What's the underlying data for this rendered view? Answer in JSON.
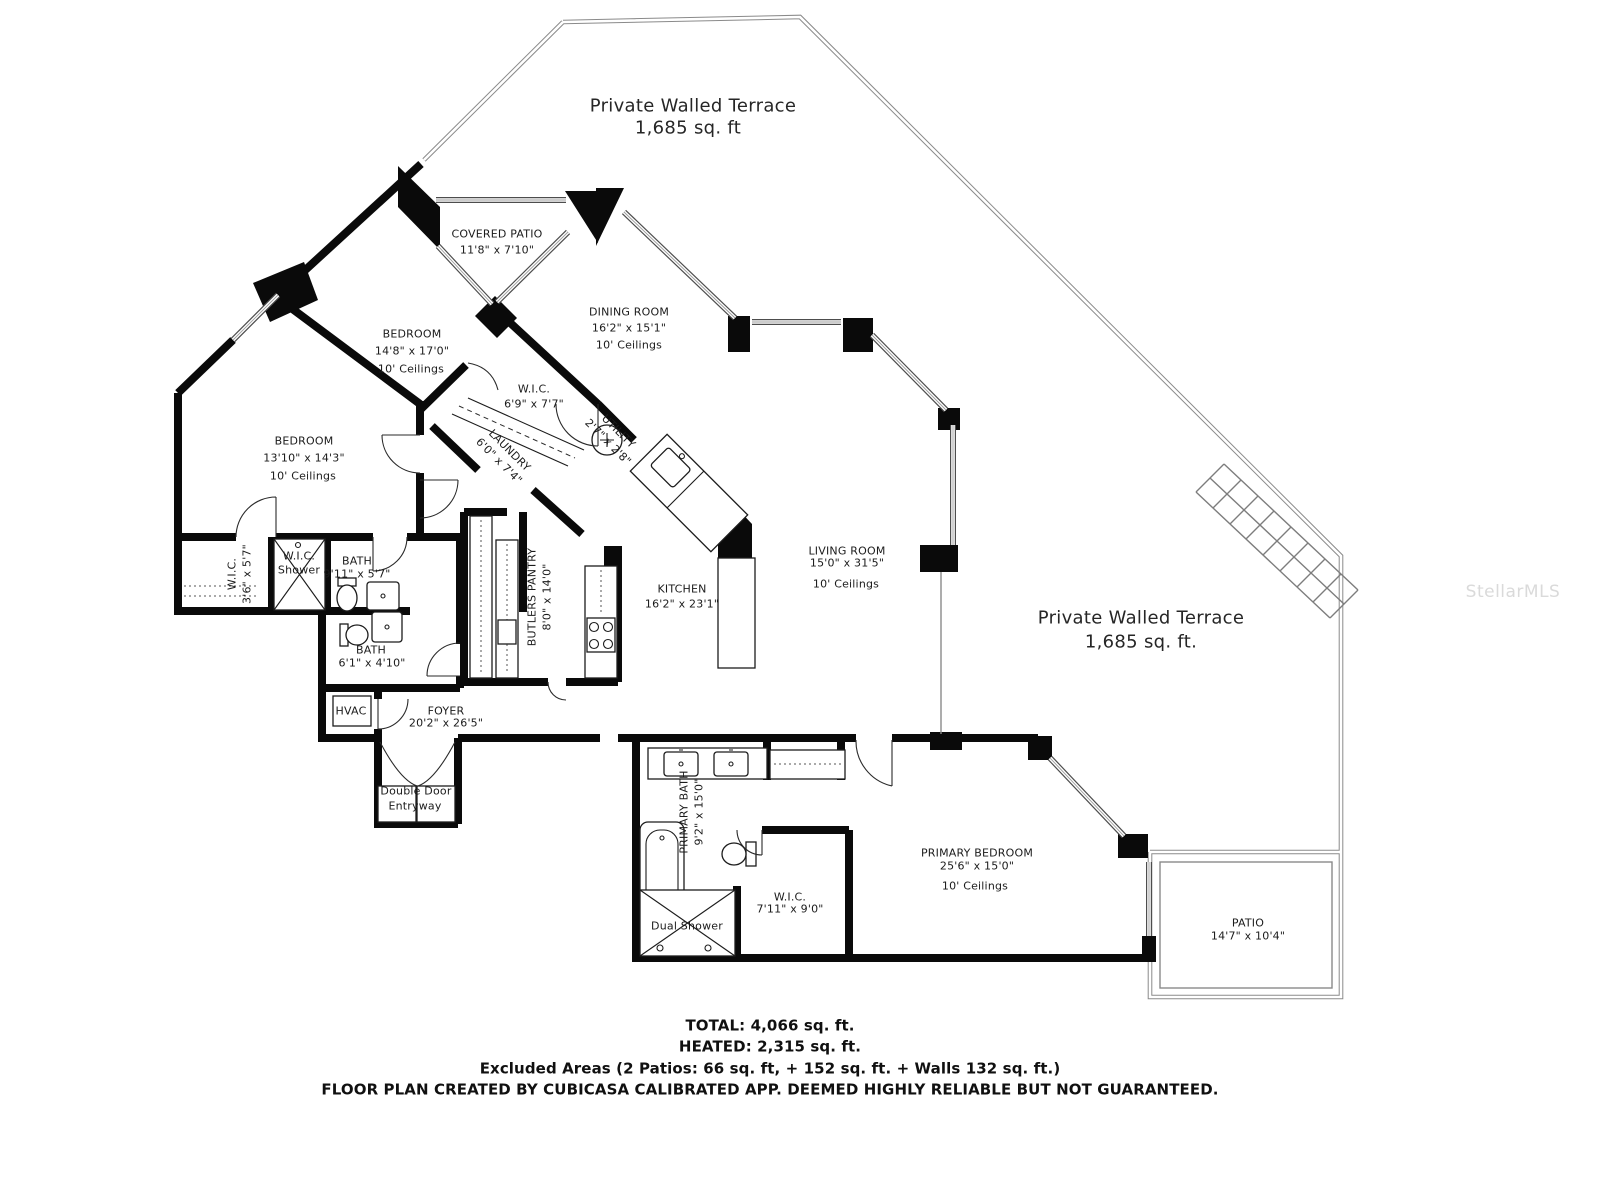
{
  "watermark": "StellarMLS",
  "terrace1": {
    "name": "Private Walled Terrace",
    "area": "1,685 sq. ft"
  },
  "terrace2": {
    "name": "Private Walled Terrace",
    "area": "1,685 sq. ft."
  },
  "rooms": {
    "covered_patio": {
      "name": "COVERED PATIO",
      "dims": "11'8\" x 7'10\""
    },
    "bedroom1": {
      "name": "BEDROOM",
      "dims": "14'8\" x 17'0\"",
      "ceilings": "10' Ceilings"
    },
    "dining": {
      "name": "DINING ROOM",
      "dims": "16'2\" x 15'1\"",
      "ceilings": "10' Ceilings"
    },
    "wic_hall": {
      "name": "W.I.C.",
      "dims": "6'9\" x 7'7\""
    },
    "laundry": {
      "name": "LAUNDRY",
      "dims": "6'0\" x 7'4\""
    },
    "utility": {
      "name": "UTILITY",
      "dims": "2'7\" x 2'8\""
    },
    "bedroom2": {
      "name": "BEDROOM",
      "dims": "13'10\" x 14'3\"",
      "ceilings": "10' Ceilings"
    },
    "wic_left": {
      "name": "W.I.C.",
      "dims": "3'6\" x 5'7\""
    },
    "wic_shower": {
      "line1": "W.I.C.",
      "line2": "Shower"
    },
    "bath1": {
      "name": "BATH",
      "dims": "9'11\" x 5'7\""
    },
    "bath2": {
      "name": "BATH",
      "dims": "6'1\" x 4'10\""
    },
    "butlers_pantry": {
      "name": "BUTLERS PANTRY",
      "dims": "8'0\" x 14'0\""
    },
    "kitchen": {
      "name": "KITCHEN",
      "dims": "16'2\" x 23'1\""
    },
    "living": {
      "name": "LIVING ROOM",
      "dims": "15'0\" x 31'5\"",
      "ceilings": "10' Ceilings"
    },
    "hvac": {
      "name": "HVAC"
    },
    "foyer": {
      "name": "FOYER",
      "dims": "20'2\" x 26'5\""
    },
    "entry": {
      "line1": "Double Door",
      "line2": "Entryway"
    },
    "primary_bath": {
      "name": "PRIMARY BATH",
      "dims": "9'2\" x 15'0\""
    },
    "dual_shower": {
      "name": "Dual Shower"
    },
    "wic_primary": {
      "name": "W.I.C.",
      "dims": "7'11\" x 9'0\""
    },
    "primary_bedroom": {
      "name": "PRIMARY BEDROOM",
      "dims": "25'6\" x 15'0\"",
      "ceilings": "10' Ceilings"
    },
    "patio": {
      "name": "PATIO",
      "dims": "14'7\" x 10'4\""
    }
  },
  "footer": {
    "total": "TOTAL: 4,066 sq. ft.",
    "heated": "HEATED: 2,315 sq. ft.",
    "excluded": "Excluded Areas (2 Patios: 66 sq. ft, + 152 sq. ft. + Walls 132 sq. ft.)",
    "disclaimer": "FLOOR PLAN CREATED BY CUBICASA CALIBRATED APP. DEEMED HIGHLY RELIABLE BUT NOT GUARANTEED."
  }
}
